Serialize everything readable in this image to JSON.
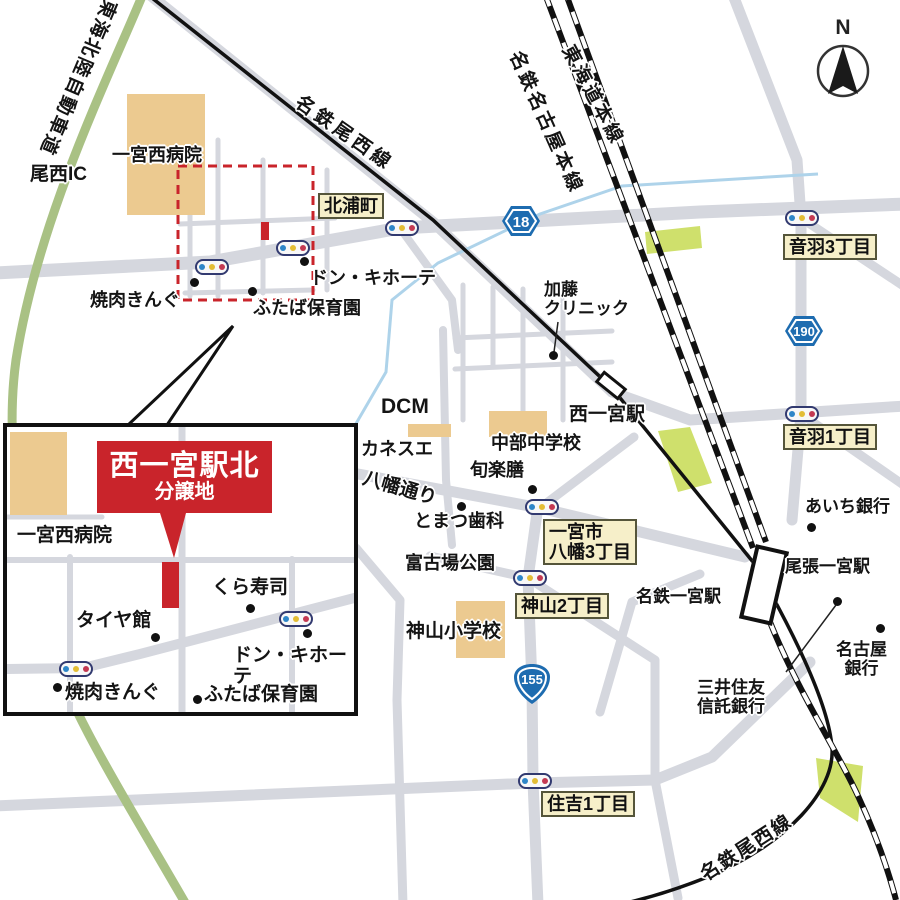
{
  "colors": {
    "accent_red": "#c9242b",
    "road_gray": "#d5d7de",
    "building_tan": "#ecca90",
    "park_green": "#cfe06c",
    "highway_green": "#a9c184",
    "water_blue": "#aed3ea",
    "label_box_cream": "#f6efc9",
    "shield_blue": "#1e6cb0"
  },
  "compass": {
    "label": "N"
  },
  "roads": {
    "tokai_hokuriku_expwy": "東海北陸自動車道",
    "onishi_ic": "尾西IC",
    "yawata_dori": "八幡通り"
  },
  "railways": {
    "meitetsu_bisai_top": "名鉄尾西線",
    "meitetsu_nagoya_main": "名鉄名古屋本線",
    "tokaido_main": "東海道本線",
    "meitetsu_bisai_bottom": "名鉄尾西線"
  },
  "route_shields": {
    "r18": "18",
    "r190": "190",
    "r155": "155"
  },
  "stations": {
    "nishi_ichinomiya": "西一宮駅",
    "owari_ichinomiya": "尾張一宮駅",
    "meitetsu_ichinomiya": "名鉄一宮駅"
  },
  "area_labels": {
    "kitauracho": "北浦町",
    "otowa3": "音羽3丁目",
    "otowa1": "音羽1丁目",
    "yawata3_line1": "一宮市",
    "yawata3_line2": "八幡3丁目",
    "kamiyama2": "神山2丁目",
    "sumiyoshi1": "住吉1丁目"
  },
  "pois": {
    "ichinomiya_nishi_hospital": "一宮西病院",
    "yakiniku_king": "焼肉きんぐ",
    "don_quijote": "ドン・キホーテ",
    "futaba_nursery": "ふたば保育園",
    "kato_clinic": "加藤\nクリニック",
    "dcm": "DCM",
    "kanesue": "カネスエ",
    "chubu_junior_high": "中部中学校",
    "shunrakuzen": "旬楽膳",
    "tomatsu_dental": "とまつ歯科",
    "fukoba_park": "富古場公園",
    "kamiyama_elementary": "神山小学校",
    "aichi_bank": "あいち銀行",
    "nagoya_bank": "名古屋\n銀行",
    "smbc_trust": "三井住友\n信託銀行"
  },
  "inset": {
    "banner_title": "西一宮駅北",
    "banner_subtitle": "分譲地",
    "hospital": "一宮西病院",
    "kura_sushi": "くら寿司",
    "tire_kan": "タイヤ館",
    "don_quijote": "ドン・キホーテ",
    "yakiniku_king": "焼肉きんぐ",
    "futaba_nursery": "ふたば保育園"
  }
}
